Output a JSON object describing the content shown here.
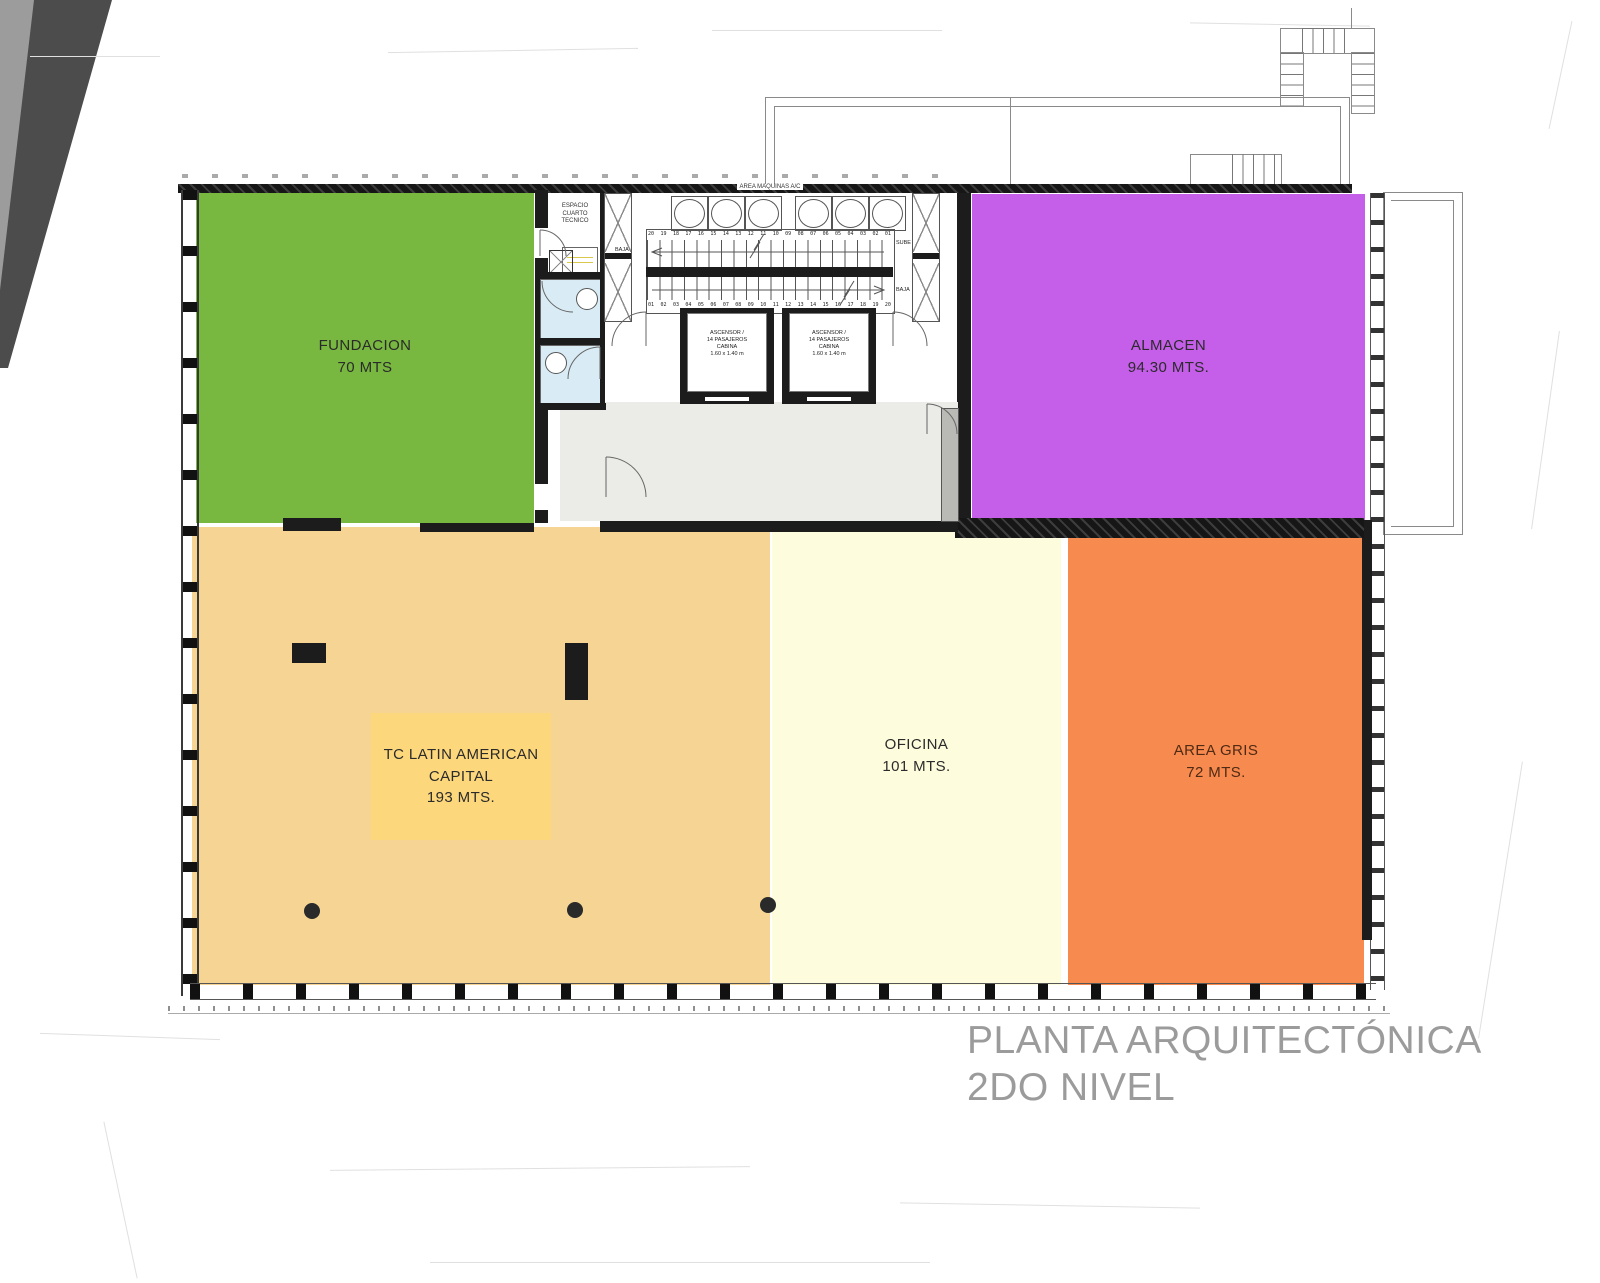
{
  "page": {
    "title_line1": "PLANTA ARQUITECTÓNICA",
    "title_line2": "2DO NIVEL"
  },
  "colors": {
    "fundacion": "#78b841",
    "almacen": "#c55ee9",
    "tc_latin": "#f6d493",
    "tc_latin_label_box": "#fcd77c",
    "oficina": "#fdfcdc",
    "area_gris": "#f78a4e",
    "lobby": "#ebebe7",
    "bathroom": "#d9ecf5",
    "wall": "#1c1c1c",
    "title_gray": "#9b9b9b"
  },
  "zones": {
    "fundacion": {
      "name": "FUNDACION",
      "area": "70 MTS"
    },
    "almacen": {
      "name": "ALMACEN",
      "area": "94.30 MTS."
    },
    "tc_latin": {
      "line1": "TC LATIN AMERICAN",
      "line2": "CAPITAL",
      "area": "193 MTS."
    },
    "oficina": {
      "name": "OFICINA",
      "area": "101 MTS."
    },
    "area_gris": {
      "name": "AREA GRIS",
      "area": "72 MTS."
    }
  },
  "core": {
    "machines_label": "AREA MAQUINAS A/C",
    "tech_room": {
      "line1": "ESPACIO",
      "line2": "CUARTO",
      "line3": "TECNICO"
    },
    "stairs": {
      "sube": "SUBE",
      "baja": "BAJA",
      "upper_steps": [
        "20",
        "19",
        "18",
        "17",
        "16",
        "15",
        "14",
        "13",
        "12",
        "11",
        "10",
        "09",
        "08",
        "07",
        "06",
        "05",
        "04",
        "03",
        "02",
        "01"
      ],
      "lower_steps": [
        "01",
        "02",
        "03",
        "04",
        "05",
        "06",
        "07",
        "08",
        "09",
        "10",
        "11",
        "12",
        "13",
        "14",
        "15",
        "16",
        "17",
        "18",
        "19",
        "20"
      ]
    },
    "elevator": {
      "lines": [
        "ASCENSOR /",
        "14 PASAJEROS",
        "CABINA",
        "1.60 x 1.40 m"
      ]
    }
  }
}
